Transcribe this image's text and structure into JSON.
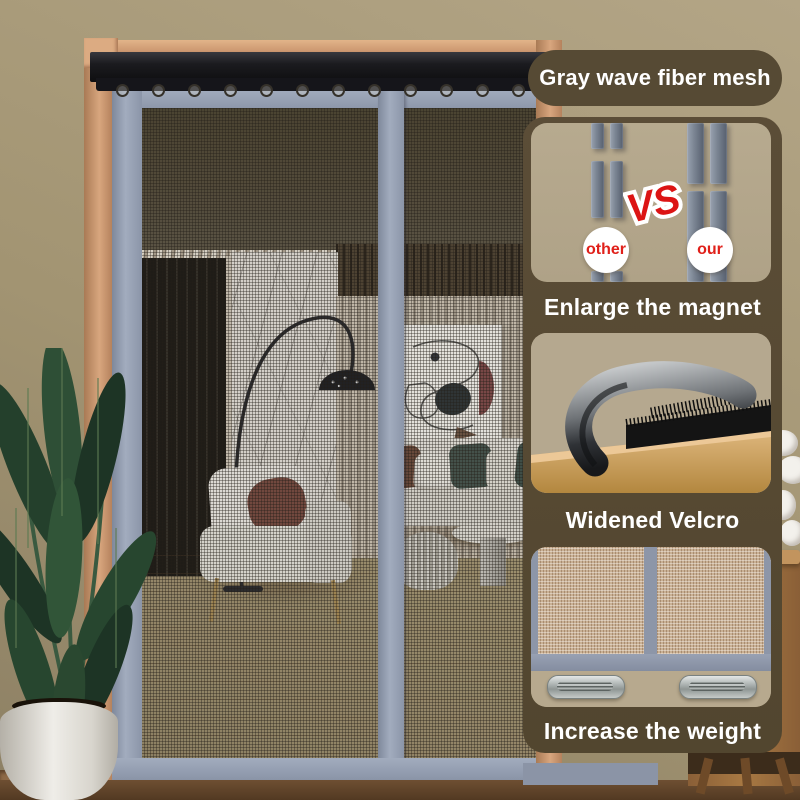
{
  "banner": {
    "mesh_label": "Gray wave fiber mesh",
    "comparison": {
      "vs": "VS",
      "other": "other",
      "our": "our"
    },
    "features": {
      "magnet_caption": "Enlarge the magnet",
      "velcro_caption": "Widened Velcro",
      "weight_caption": "Increase the weight"
    },
    "colors": {
      "panel_brown": "#564a34",
      "accent_red": "#e0201a",
      "screen_frame_gray": "#97a1b3",
      "card_tan": "#b4a78c",
      "wall_tan": "#a29472"
    }
  }
}
